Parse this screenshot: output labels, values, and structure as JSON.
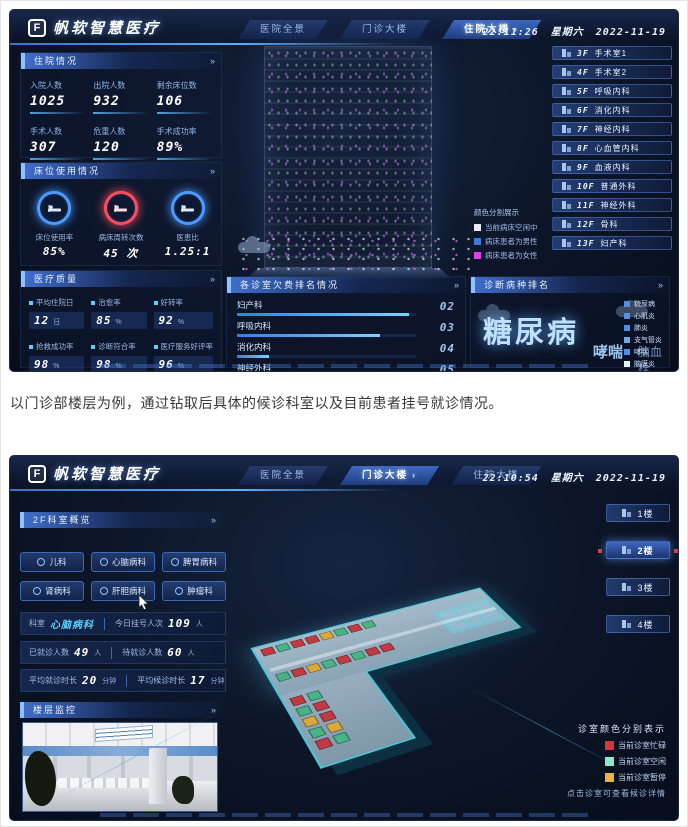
{
  "icons": {
    "chevron": "›",
    "panel_arrow": "»",
    "logo_glyph": "F"
  },
  "page": {
    "caption": "以门诊部楼层为例，通过钻取后具体的候诊科室以及目前患者挂号就诊情况。"
  },
  "brand": {
    "name": "帆软智慧医疗"
  },
  "dash1": {
    "tabs": [
      {
        "label": "医院全景"
      },
      {
        "label": "门诊大楼"
      },
      {
        "label": "住院大楼"
      }
    ],
    "clock": {
      "time": "22:11:26",
      "week": "星期六",
      "date": "2022-11-19"
    },
    "inpatient": {
      "title": "住院情况",
      "stats": [
        {
          "label": "入院人数",
          "value": "1025"
        },
        {
          "label": "出院人数",
          "value": "932"
        },
        {
          "label": "剩余床位数",
          "value": "106"
        },
        {
          "label": "手术人数",
          "value": "307"
        },
        {
          "label": "危重人数",
          "value": "120"
        },
        {
          "label": "手术成功率",
          "value": "89%"
        }
      ]
    },
    "bedUse": {
      "title": "床位使用情况",
      "gauges": [
        {
          "label": "床位使用率",
          "value": "85%",
          "color": "#4d9bff"
        },
        {
          "label": "病床周转次数",
          "value": "45 次",
          "color": "#ff4d5e"
        },
        {
          "label": "医患比",
          "value": "1.25:1",
          "color": "#4d9bff"
        }
      ]
    },
    "quality": {
      "title": "医疗质量",
      "stats": [
        {
          "label": "平均住院日",
          "value": "12",
          "unit": "日"
        },
        {
          "label": "治愈率",
          "value": "85",
          "unit": "%"
        },
        {
          "label": "好转率",
          "value": "92",
          "unit": "%"
        },
        {
          "label": "抢救成功率",
          "value": "98",
          "unit": "%"
        },
        {
          "label": "诊断符合率",
          "value": "98",
          "unit": "%"
        },
        {
          "label": "医疗服务好评率",
          "value": "96",
          "unit": "%"
        }
      ]
    },
    "arrears": {
      "title": "各诊室欠费排名情况",
      "rows": [
        {
          "label": "妇产科",
          "rank": "02",
          "width": 96
        },
        {
          "label": "呼吸内科",
          "rank": "03",
          "width": 80
        },
        {
          "label": "消化内科",
          "rank": "04",
          "width": 18
        },
        {
          "label": "神经外科",
          "rank": "05",
          "width": 15
        }
      ]
    },
    "disease": {
      "title": "诊断病种排名",
      "cloud": {
        "big": "糖尿病",
        "mid": "哮喘",
        "small": "脑血栓"
      },
      "legend": [
        {
          "label": "糖尿病",
          "color": "#4f8fe8"
        },
        {
          "label": "心肌炎",
          "color": "#4f8fe8"
        },
        {
          "label": "肺炎",
          "color": "#4f8fe8"
        },
        {
          "label": "支气管炎",
          "color": "#6fa8e8"
        },
        {
          "label": "哮喘",
          "color": "#4f8fe8"
        },
        {
          "label": "脑膜炎",
          "color": "#e6eef8"
        },
        {
          "label": "脑血栓",
          "color": "#4f8fe8"
        }
      ]
    },
    "floors": [
      {
        "num": "3F",
        "name": "手术室1"
      },
      {
        "num": "4F",
        "name": "手术室2"
      },
      {
        "num": "5F",
        "name": "呼吸内科"
      },
      {
        "num": "6F",
        "name": "消化内科"
      },
      {
        "num": "7F",
        "name": "神经内科"
      },
      {
        "num": "8F",
        "name": "心血管内科"
      },
      {
        "num": "9F",
        "name": "血液内科"
      },
      {
        "num": "10F",
        "name": "普通外科"
      },
      {
        "num": "11F",
        "name": "神经外科"
      },
      {
        "num": "12F",
        "name": "骨科"
      },
      {
        "num": "13F",
        "name": "妇产科"
      }
    ],
    "bedLegend": {
      "title": "颜色分割展示",
      "items": [
        {
          "label": "当前病床空闲中",
          "color": "#e6edf5"
        },
        {
          "label": "病床患者为男性",
          "color": "#3e7be0"
        },
        {
          "label": "病床患者为女性",
          "color": "#d944e8"
        }
      ]
    }
  },
  "dash2": {
    "clock": {
      "time": "22:10:54",
      "week": "星期六",
      "date": "2022-11-19"
    },
    "overview": {
      "title": "2F科室概览",
      "depts": [
        {
          "label": "儿科"
        },
        {
          "label": "心脑病科"
        },
        {
          "label": "脾胃病科"
        },
        {
          "label": "肾病科"
        },
        {
          "label": "肝胆病科"
        },
        {
          "label": "肿瘤科"
        }
      ],
      "deptLabel": "科室",
      "deptValue": "心脑病科",
      "stats": [
        {
          "label": "今日挂号人次",
          "value": "109",
          "unit": "人"
        },
        {
          "label": "已就诊人数",
          "value": "49",
          "unit": "人"
        },
        {
          "label": "待就诊人数",
          "value": "60",
          "unit": "人"
        },
        {
          "label": "平均就诊时长",
          "value": "20",
          "unit": "分钟"
        },
        {
          "label": "平均候诊时长",
          "value": "17",
          "unit": "分钟"
        }
      ]
    },
    "monitor": {
      "title": "楼层监控"
    },
    "floors": [
      {
        "label": "1楼"
      },
      {
        "label": "2楼"
      },
      {
        "label": "3楼"
      },
      {
        "label": "4楼"
      }
    ],
    "legend": {
      "title": "诊室颜色分别表示",
      "items": [
        {
          "label": "当前诊室忙碌",
          "color": "#d2373f"
        },
        {
          "label": "当前诊室空闲",
          "color": "#8fe8c8"
        },
        {
          "label": "当前诊室暂停",
          "color": "#e8b33f"
        }
      ],
      "hint": "点击诊室可查看候诊详情"
    },
    "map": {
      "rooms": [
        "#c23a41",
        "#49b385",
        "#c23a41",
        "#c23a41",
        "#d9a93a",
        "#49b385",
        "#c23a41",
        "#49b385",
        "#49b385",
        "#c23a41",
        "#d9a93a",
        "#49b385",
        "#c23a41",
        "#49b385",
        "#c23a41",
        "#c23a41",
        "#c23a41",
        "#49b385",
        "#49b385",
        "#c23a41",
        "#d9a93a",
        "#c23a41",
        "#49b385",
        "#d9a93a",
        "#c23a41",
        "#49b385"
      ]
    }
  }
}
